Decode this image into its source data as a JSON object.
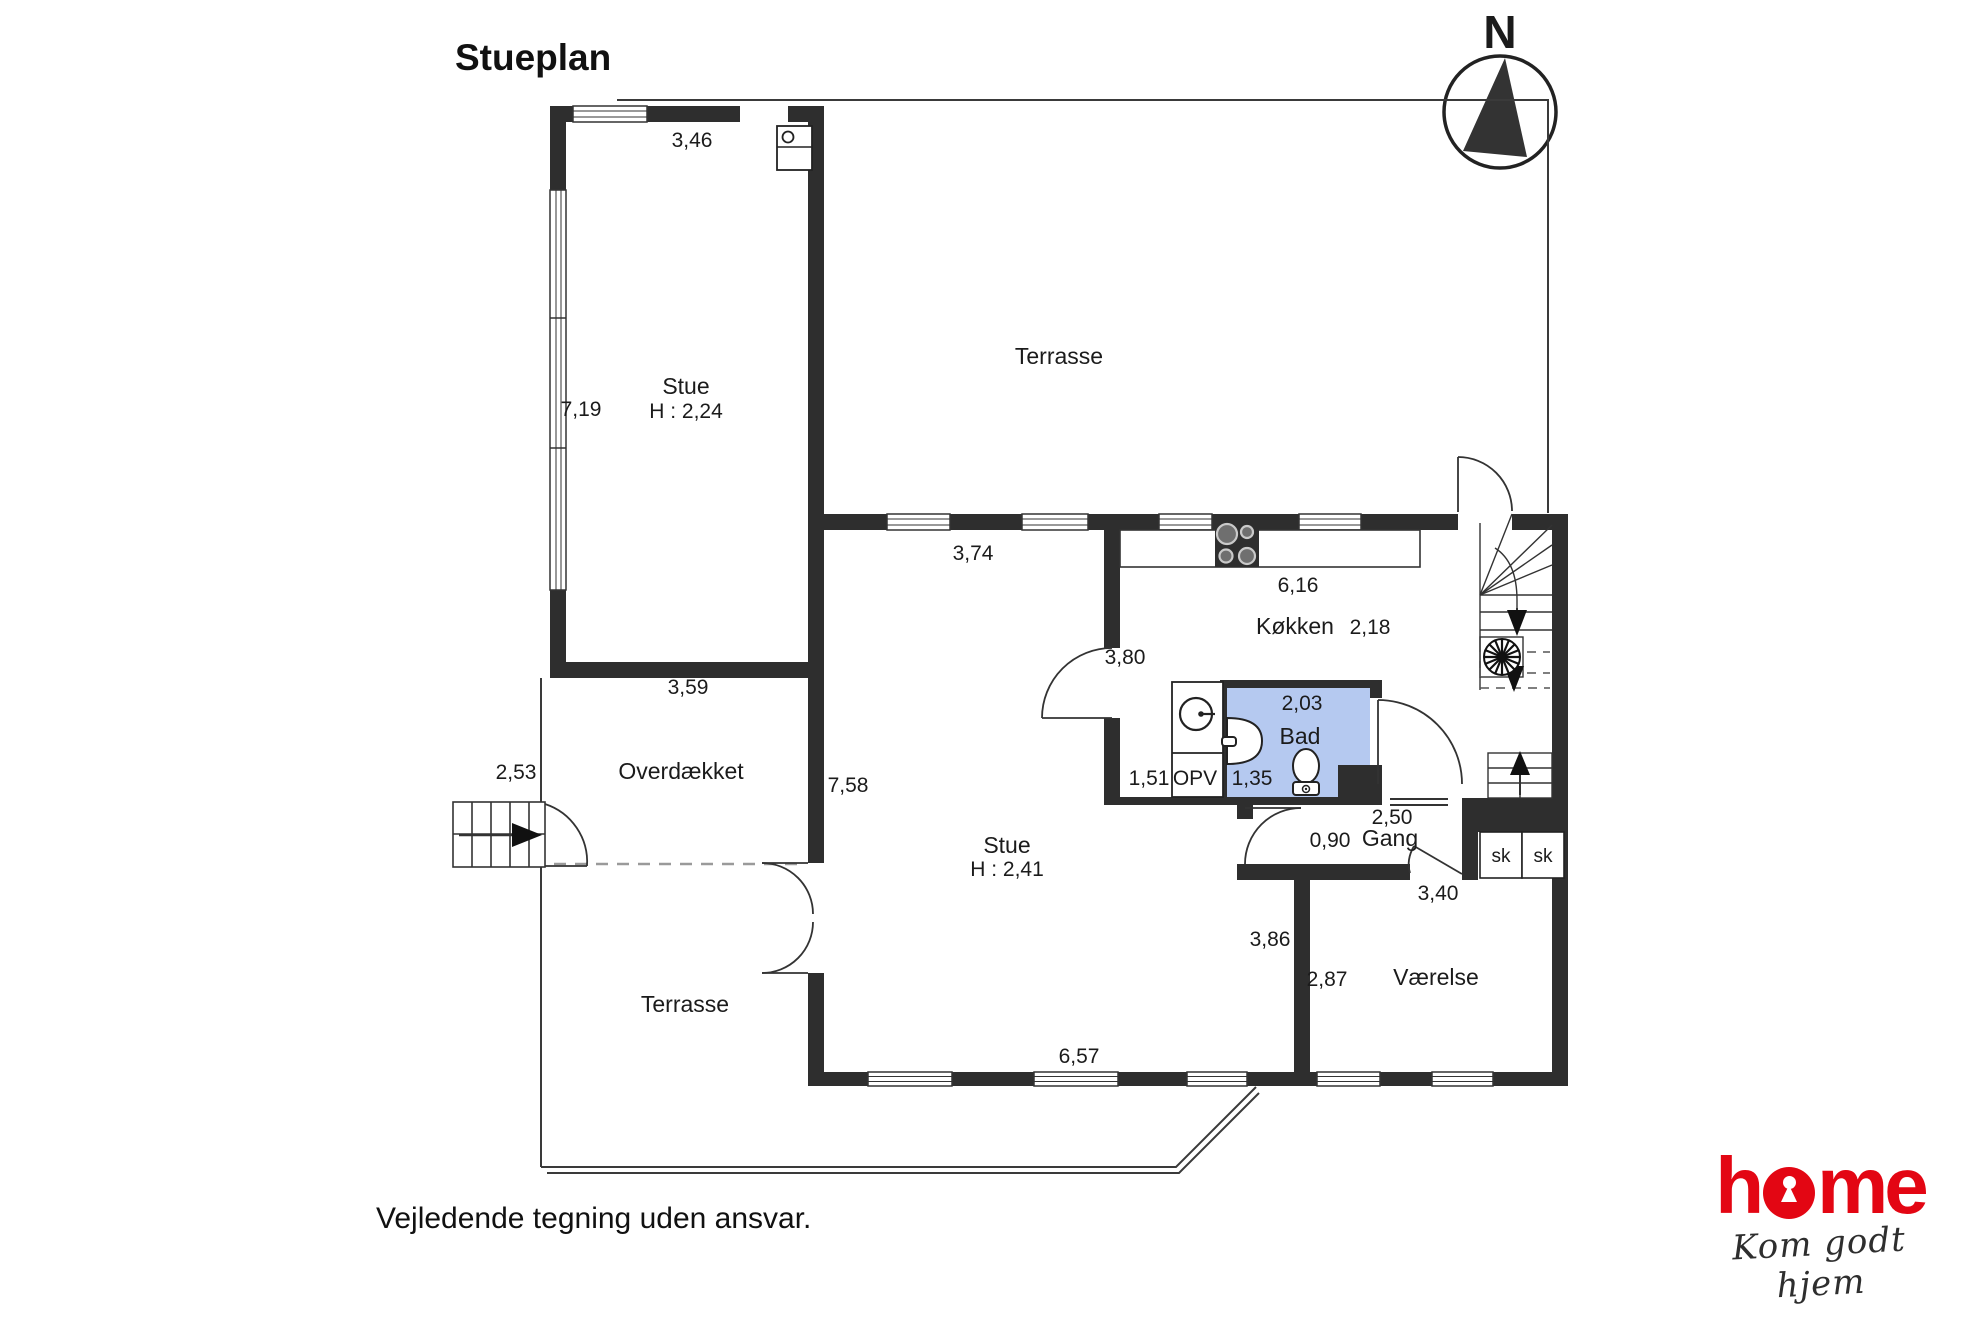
{
  "title": "Stueplan",
  "disclaimer": "Vejledende tegning uden ansvar.",
  "compass": {
    "label": "N"
  },
  "logo": {
    "brand_h": "h",
    "brand_me": "me",
    "tagline": "Kom godt hjem"
  },
  "colors": {
    "wall": "#2e2e2e",
    "bath_fill": "#b5c9f0",
    "logo_red": "#e30613"
  },
  "rooms": {
    "stue_annex": {
      "label": "Stue",
      "ceiling": "H : 2,24"
    },
    "terrasse_top": {
      "label": "Terrasse"
    },
    "koekken": {
      "label": "Køkken"
    },
    "bad": {
      "label": "Bad"
    },
    "opv": {
      "label": "OPV"
    },
    "gang": {
      "label": "Gang"
    },
    "stue_main": {
      "label": "Stue",
      "ceiling": "H : 2,41"
    },
    "overdaekket": {
      "label": "Overdækket"
    },
    "terrasse_bottom": {
      "label": "Terrasse"
    },
    "vaerelse": {
      "label": "Værelse"
    },
    "closet_left": {
      "label": "sk"
    },
    "closet_right": {
      "label": "sk"
    }
  },
  "measurements": {
    "annex_width": "3,46",
    "annex_height": "7,19",
    "stue_top_width": "3,74",
    "kitchen_width": "6,16",
    "kitchen_depth": "2,18",
    "stue_upper_depth": "3,80",
    "bad_width": "2,03",
    "opv_left": "1,51",
    "bad_inner": "1,35",
    "gang_width": "2,50",
    "gang_door": "0,90",
    "vaerelse_top": "3,40",
    "stue_right_depth": "3,86",
    "vaerelse_left": "2,87",
    "stue_bottom_width": "6,57",
    "stue_left_height": "7,58",
    "overdaekket_width": "3,59",
    "outside_stairs_width": "2,53"
  }
}
